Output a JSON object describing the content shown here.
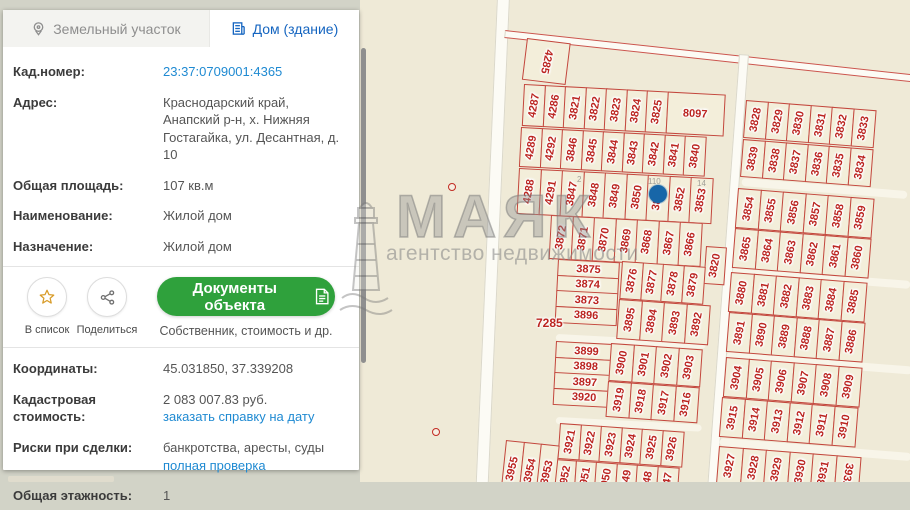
{
  "panel": {
    "tabs": [
      {
        "label": "Земельный участок",
        "active": false
      },
      {
        "label": "Дом (здание)",
        "active": true
      }
    ],
    "fields1": [
      {
        "label": "Кад.номер:",
        "lines": [
          {
            "t": "23:37:0709001:4365",
            "link": true
          }
        ]
      },
      {
        "label": "Адрес:",
        "lines": [
          {
            "t": "Краснодарский край, Анапский р-н, х. Нижняя Гостагайка, ул. Десантная, д. 10"
          }
        ]
      },
      {
        "label": "Общая площадь:",
        "lines": [
          {
            "t": "107 кв.м"
          }
        ]
      },
      {
        "label": "Наименование:",
        "lines": [
          {
            "t": "Жилой дом"
          }
        ]
      },
      {
        "label": "Назначение:",
        "lines": [
          {
            "t": "Жилой дом"
          }
        ]
      }
    ],
    "actions": {
      "star_label": "В список",
      "share_label": "Поделиться",
      "docs_button": "Документы объекта",
      "docs_subtitle": "Собственник, стоимость и др.",
      "button_color": "#2fa13c"
    },
    "fields2": [
      {
        "label": "Координаты:",
        "lines": [
          {
            "t": "45.031850, 37.339208"
          }
        ]
      },
      {
        "label": "Кадастровая стоимость:",
        "lines": [
          {
            "t": "2 083 007.83 руб."
          },
          {
            "t": "заказать справку на дату",
            "link": true
          }
        ]
      },
      {
        "label": "Риски при сделки:",
        "lines": [
          {
            "t": "банкротства, аресты, суды"
          },
          {
            "t": "полная проверка",
            "link": true
          }
        ]
      },
      {
        "label": "Общая этажность:",
        "lines": [
          {
            "t": "1"
          }
        ]
      }
    ],
    "accent_link_color": "#1f8ad2",
    "tab_active_color": "#1565c0"
  },
  "watermark": {
    "title": "МАЯК",
    "subtitle": "агентство недвижимости"
  },
  "map": {
    "colors": {
      "background": "#efead7",
      "parcel_fill": "#f3eeda",
      "parcel_border": "#ba2820",
      "number": "#bb2420",
      "road": "#fcfbf5",
      "marker": "#1766a8"
    },
    "roads": [
      {
        "x": 497,
        "y": -4,
        "w": 13,
        "h": 492,
        "rot": 2.5,
        "redged": false
      },
      {
        "x": 505,
        "y": 30,
        "w": 412,
        "h": 8,
        "rot": 6.2,
        "redged": true
      },
      {
        "x": 739,
        "y": 54,
        "w": 10,
        "h": 436,
        "rot": 4.2,
        "redged": false
      }
    ],
    "streets": [
      {
        "x": 742,
        "y": 178,
        "w": 166,
        "h": 8,
        "rot": 4.5
      },
      {
        "x": 733,
        "y": 267,
        "w": 178,
        "h": 8,
        "rot": 4.5
      },
      {
        "x": 727,
        "y": 352,
        "w": 186,
        "h": 8,
        "rot": 4.5
      },
      {
        "x": 720,
        "y": 438,
        "w": 192,
        "h": 8,
        "rot": 4.5
      },
      {
        "x": 556,
        "y": 417,
        "w": 146,
        "h": 7,
        "rot": 3
      },
      {
        "x": 556,
        "y": 334,
        "w": 150,
        "h": 7,
        "rot": 3
      }
    ],
    "blocks": [
      {
        "x": 527,
        "y": 38,
        "rot": 7,
        "w": 44,
        "h": 42,
        "lr": 95,
        "cells": [
          "4285"
        ]
      },
      {
        "x": 524,
        "y": 84,
        "rot": 3,
        "w": 22,
        "h": 42,
        "cells": [
          "4287",
          "4286",
          "3821",
          "3822",
          "3823",
          "3824",
          "3825",
          {
            "t": "8097",
            "w": 58,
            "h0": true
          }
        ]
      },
      {
        "x": 521,
        "y": 127,
        "rot": 3,
        "w": 22,
        "h": 40,
        "cells": [
          "4289",
          "4292",
          "3846",
          "3845",
          "3844",
          "3843",
          "3842",
          "3841",
          "3840"
        ]
      },
      {
        "x": 519,
        "y": 168,
        "rot": 3,
        "w": 23,
        "h": 46,
        "cells": [
          "4288",
          "4291",
          "3847",
          "3848",
          "3849",
          "3850",
          "3851",
          "3852",
          "3853"
        ]
      },
      {
        "x": 551,
        "y": 215,
        "rot": 3,
        "w": 23,
        "h": 44,
        "cells": [
          "3872",
          "3871",
          "3870",
          "3869",
          "3868",
          "3867",
          "3866"
        ]
      },
      {
        "x": 706,
        "y": 246,
        "rot": 4,
        "w": 21,
        "h": 38,
        "cells": [
          "3820"
        ]
      },
      {
        "x": 558,
        "y": 259,
        "rot": 3,
        "col": true,
        "h0": true,
        "w": 62,
        "h": 17,
        "cells": [
          "3875",
          "3874",
          "3873",
          "3896"
        ]
      },
      {
        "x": 622,
        "y": 261,
        "rot": 4,
        "w": 22,
        "h": 38,
        "cells": [
          "3876",
          "3877",
          "3878",
          "3879"
        ]
      },
      {
        "x": 619,
        "y": 299,
        "rot": 4,
        "w": 24,
        "h": 40,
        "cells": [
          "3895",
          "3894",
          "3893",
          "3892"
        ]
      },
      {
        "x": 556,
        "y": 341,
        "rot": 3,
        "col": true,
        "h0": true,
        "w": 62,
        "h": 17,
        "cells": [
          "3899",
          "3898",
          "3897",
          "3920"
        ]
      },
      {
        "x": 611,
        "y": 343,
        "rot": 4,
        "w": 24,
        "h": 38,
        "cells": [
          "3900",
          "3901",
          "3902",
          "3903"
        ]
      },
      {
        "x": 608,
        "y": 381,
        "rot": 4,
        "w": 24,
        "h": 36,
        "cells": [
          "3919",
          "3918",
          "3917",
          "3916"
        ]
      },
      {
        "x": 560,
        "y": 423,
        "rot": 4,
        "w": 22,
        "h": 36,
        "cells": [
          "3921",
          "3922",
          "3923",
          "3924",
          "3925",
          "3926"
        ]
      },
      {
        "x": 555,
        "y": 459,
        "rot": 4,
        "w": 22,
        "h": 36,
        "cells": [
          "3952",
          "3951",
          "3950",
          "3949",
          "3948",
          "3947"
        ]
      },
      {
        "x": 506,
        "y": 440,
        "rot": 6,
        "w": 19,
        "h": 56,
        "cells": [
          "3955",
          "3954",
          "3953"
        ]
      },
      {
        "x": 746,
        "y": 100,
        "rot": 4.5,
        "w": 23,
        "h": 38,
        "cells": [
          "3828",
          "3829",
          "3830",
          "3831",
          "3832",
          "3833"
        ]
      },
      {
        "x": 743,
        "y": 139,
        "rot": 4.5,
        "w": 23,
        "h": 38,
        "cells": [
          "3839",
          "3838",
          "3837",
          "3836",
          "3835",
          "3834"
        ]
      },
      {
        "x": 738,
        "y": 188,
        "rot": 4.5,
        "w": 24,
        "h": 40,
        "cells": [
          "3854",
          "3855",
          "3856",
          "3857",
          "3858",
          "3859"
        ]
      },
      {
        "x": 735,
        "y": 228,
        "rot": 4.5,
        "w": 24,
        "h": 40,
        "cells": [
          "3865",
          "3864",
          "3863",
          "3862",
          "3861",
          "3860"
        ]
      },
      {
        "x": 731,
        "y": 272,
        "rot": 4.5,
        "w": 24,
        "h": 40,
        "cells": [
          "3880",
          "3881",
          "3882",
          "3883",
          "3884",
          "3885"
        ]
      },
      {
        "x": 729,
        "y": 312,
        "rot": 4.5,
        "w": 24,
        "h": 40,
        "cells": [
          "3891",
          "3890",
          "3889",
          "3888",
          "3887",
          "3886"
        ]
      },
      {
        "x": 726,
        "y": 357,
        "rot": 4.5,
        "w": 24,
        "h": 40,
        "cells": [
          "3904",
          "3905",
          "3906",
          "3907",
          "3908",
          "3909"
        ]
      },
      {
        "x": 722,
        "y": 397,
        "rot": 4.5,
        "w": 24,
        "h": 40,
        "cells": [
          "3915",
          "3914",
          "3913",
          "3912",
          "3911",
          "3910"
        ]
      },
      {
        "x": 719,
        "y": 446,
        "rot": 4.5,
        "w": 25,
        "h": 38,
        "cells": [
          "3927",
          "3928",
          "3929",
          "3930",
          "3931",
          {
            "t": "3932",
            "lr": 95
          }
        ]
      }
    ],
    "texts": [
      {
        "t": "7285",
        "x": 536,
        "y": 316
      },
      {
        "t": "2",
        "x": 577,
        "y": 175,
        "faint": true
      },
      {
        "t": "110",
        "x": 648,
        "y": 177,
        "faint": true
      },
      {
        "t": "14",
        "x": 697,
        "y": 179,
        "faint": true
      }
    ],
    "marker": {
      "x": 649,
      "y": 185
    },
    "red_points": [
      {
        "x": 448,
        "y": 183
      },
      {
        "x": 432,
        "y": 428
      }
    ]
  }
}
